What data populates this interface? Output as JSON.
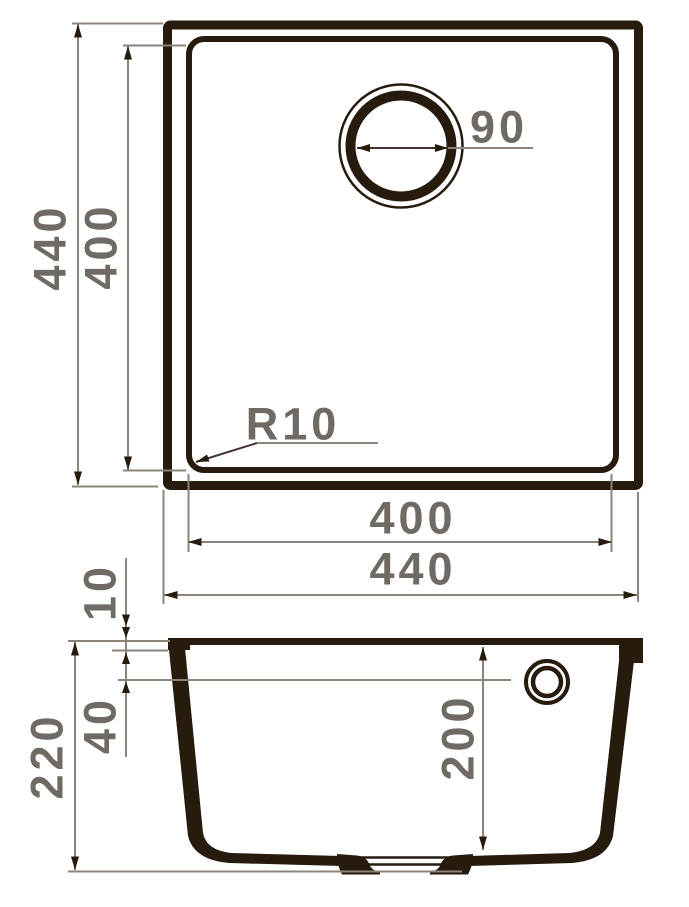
{
  "colors": {
    "ink": "#271b0e",
    "ink_dim": "#43332a",
    "dim_line": "#8d8479",
    "label": "#6f6a64",
    "background": "#ffffff"
  },
  "top_view": {
    "outer_height": "440",
    "inner_height": "400",
    "drain_diameter": "90",
    "corner_radius": "R10",
    "inner_width": "400",
    "outer_width": "440"
  },
  "side_view": {
    "rim_height": "10",
    "overflow_offset": "40",
    "total_depth": "220",
    "bowl_depth": "200"
  }
}
